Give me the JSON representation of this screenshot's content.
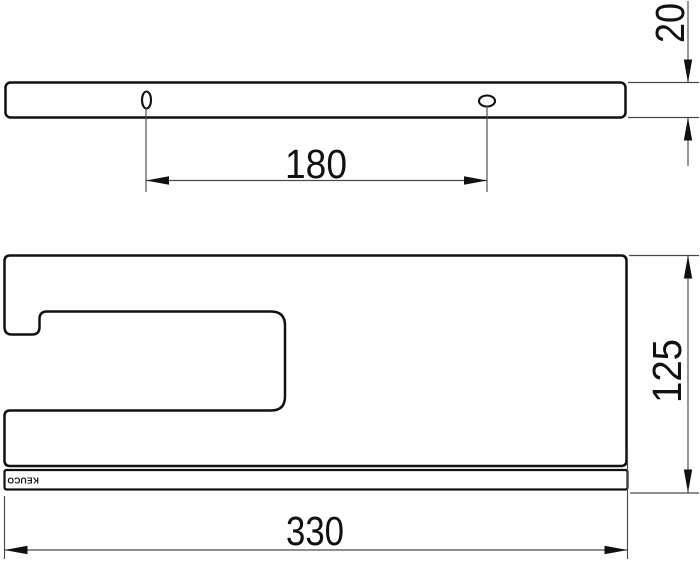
{
  "drawing": {
    "type": "technical-drawing",
    "views": {
      "top_view_name": "wall mounting bar (top view)",
      "side_view_name": "shelf side profile"
    },
    "dimensions": {
      "hole_spacing": "180",
      "thickness": "20",
      "height": "125",
      "width": "330"
    },
    "logo_text": "KEUCO",
    "colors": {
      "outline": "#111111",
      "dimension_lines": "#4a4a4a",
      "background": "#ffffff"
    }
  }
}
